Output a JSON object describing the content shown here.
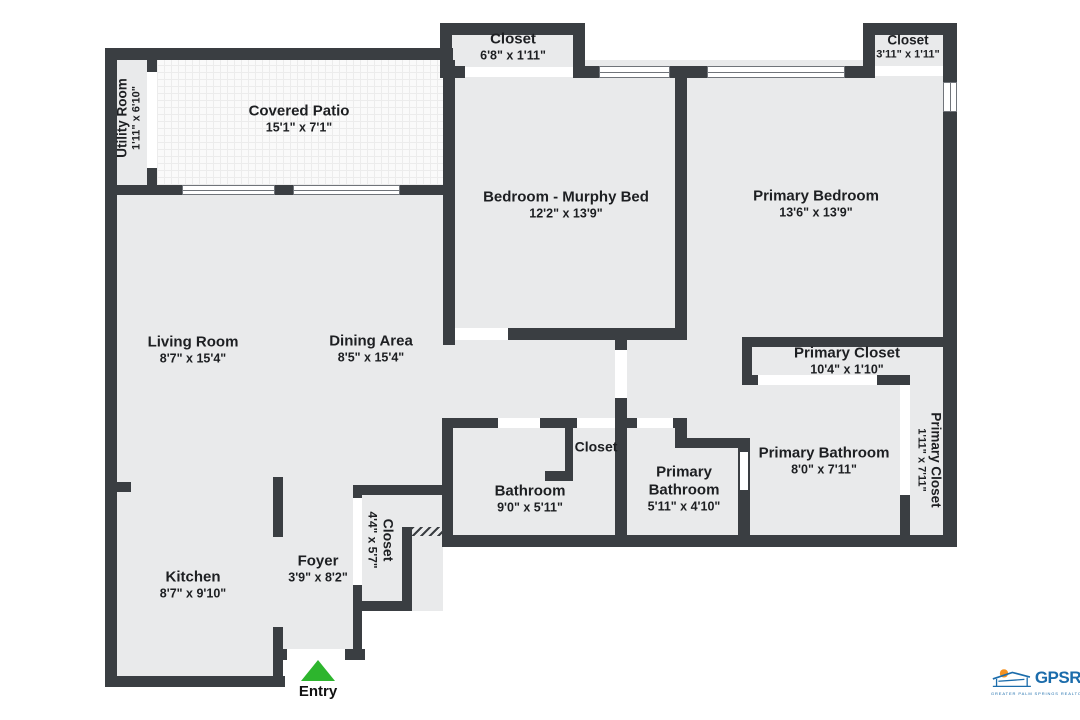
{
  "plan": {
    "rooms": [
      {
        "id": "utility-room",
        "label": "Utility Room",
        "dims": "1'11\" x 6'10\""
      },
      {
        "id": "covered-patio",
        "label": "Covered Patio",
        "dims": "15'1\" x 7'1\""
      },
      {
        "id": "closet-top-middle",
        "label": "Closet",
        "dims": "6'8\" x 1'11\""
      },
      {
        "id": "closet-top-right",
        "label": "Closet",
        "dims": "3'11\" x 1'11\""
      },
      {
        "id": "bedroom-murphy-bed",
        "label": "Bedroom - Murphy Bed",
        "dims": "12'2\" x 13'9\""
      },
      {
        "id": "primary-bedroom",
        "label": "Primary Bedroom",
        "dims": "13'6\" x 13'9\""
      },
      {
        "id": "living-room",
        "label": "Living Room",
        "dims": "8'7\" x 15'4\""
      },
      {
        "id": "dining-area",
        "label": "Dining Area",
        "dims": "8'5\" x 15'4\""
      },
      {
        "id": "primary-closet-upper",
        "label": "Primary Closet",
        "dims": "10'4\" x 1'10\""
      },
      {
        "id": "primary-closet-side",
        "label": "Primary Closet",
        "dims": "1'11\" x 7'11\""
      },
      {
        "id": "hall-closet",
        "label": "Closet",
        "dims": ""
      },
      {
        "id": "bathroom",
        "label": "Bathroom",
        "dims": "9'0\" x 5'11\""
      },
      {
        "id": "primary-bathroom-small",
        "label": "Primary Bathroom",
        "dims": "5'11\" x 4'10\""
      },
      {
        "id": "primary-bathroom-large",
        "label": "Primary Bathroom",
        "dims": "8'0\" x 7'11\""
      },
      {
        "id": "kitchen",
        "label": "Kitchen",
        "dims": "8'7\" x 9'10\""
      },
      {
        "id": "foyer",
        "label": "Foyer",
        "dims": "3'9\" x 8'2\""
      },
      {
        "id": "foyer-closet",
        "label": "Closet",
        "dims": "4'4\" x 5'7\""
      }
    ],
    "entry": {
      "label": "Entry"
    },
    "logo": {
      "brand": "GPSR",
      "tagline": "GREATER PALM SPRINGS REALTORS"
    },
    "colors": {
      "wall": "#3a3e42",
      "floor": "#e9eaeb",
      "entry_arrow": "#2db52d",
      "logo_blue": "#1b6cab",
      "logo_orange": "#f59120"
    }
  }
}
